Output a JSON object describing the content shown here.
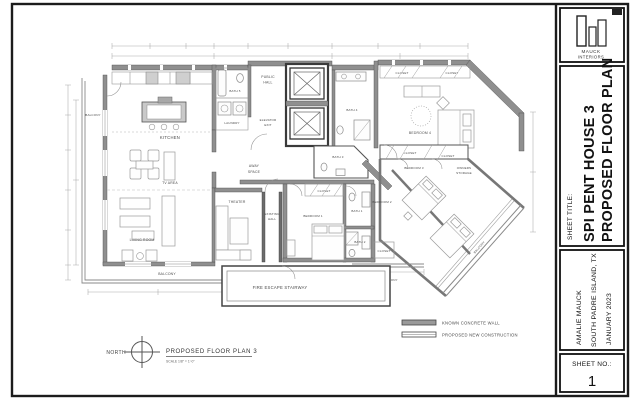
{
  "colors": {
    "ink": "#1c1c1c",
    "wall_gray": "#8f8f8f",
    "paper": "#ffffff"
  },
  "logo": {
    "line1": "MAUCK",
    "line2": "INTERIORS"
  },
  "title_block": {
    "sheet_title_label": "SHEET TITLE:",
    "title_line1": "SPI PENT HOUSE 3",
    "title_line2": "PROPOSED FLOOR PLAN",
    "author": "AMALIE MAUCK",
    "location": "SOUTH PADRE ISLAND, TX",
    "date": "JANUARY 2023",
    "sheet_no_label": "SHEET NO.:",
    "sheet_no": "1"
  },
  "plan": {
    "labels": {
      "kitchen": "KITCHEN",
      "tv_area": "TV AREA",
      "living_room": "LIVING ROOM",
      "theater": "THEATER",
      "away_line1": "AWAY",
      "away_line2": "SPACE",
      "public_line1": "PUBLIC",
      "public_line2": "HALL",
      "elevator_line1": "ELEVATOR",
      "elevator_line2": "EXIT",
      "existing_line1": "EXISTING",
      "existing_line2": "HALL",
      "laundry": "LAUNDRY",
      "bath1": "BATH 1",
      "bath2": "BATH 2",
      "bath3": "BATH 3",
      "bath4": "BATH 4",
      "bath5": "BATH 5",
      "bedroom1": "BEDROOM 1",
      "bedroom2": "BEDROOM 2",
      "bedroom3": "BEDROOM 3",
      "bedroom4": "BEDROOM 4",
      "closet": "CLOSET",
      "owners_line1": "OWNERS",
      "owners_line2": "STORAGE",
      "balcony": "BALCONY",
      "fire_escape": "FIRE ESCAPE STAIRWAY"
    },
    "footer": {
      "north": "NORTH",
      "title": "PROPOSED FLOOR PLAN 3",
      "scale": "SCALE 1/8\" = 1'-0\""
    },
    "legend": {
      "concrete": "KNOWN CONCRETE WALL",
      "new_construction": "PROPOSED NEW CONSTRUCTION"
    }
  }
}
